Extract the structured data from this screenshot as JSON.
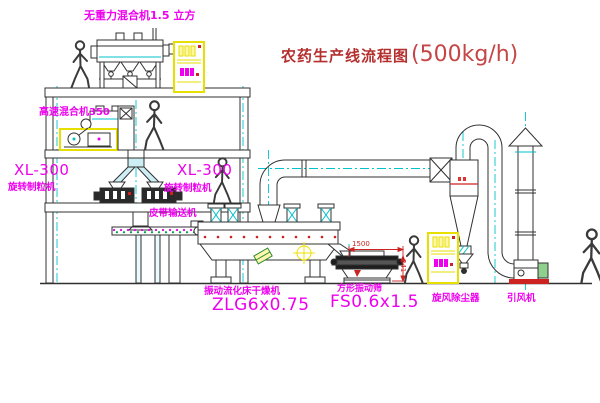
{
  "title": {
    "name": "农药生产线流程图",
    "capacity": "(500kg/h)"
  },
  "labels": {
    "gravity_mixer": "无重力混合机1.5 立方",
    "high_speed_mixer": "高速混合机350",
    "granulator_left_model": "XL-300",
    "granulator_left_name": "旋转制粒机",
    "granulator_right_model": "XL-300",
    "granulator_right_name": "旋转制粒机",
    "belt_conveyor": "皮带输送机",
    "dryer_name": "振动流化床干燥机",
    "dryer_model": "ZLG6x0.75",
    "sieve_name": "方形振动筛",
    "sieve_model": "FS0.6x1.5",
    "cyclone": "旋风除尘器",
    "fan": "引风机"
  },
  "dimensions": {
    "sieve_length": "1500",
    "sieve_height": "341"
  },
  "colors": {
    "drawing_line": "#303030",
    "centerline_cyan": "#00c2cc",
    "label_magenta": "#ee00ee",
    "title_red": "#b52f2f",
    "cabinet_yellow": "#e6df00",
    "dim_red": "#cc2222"
  }
}
